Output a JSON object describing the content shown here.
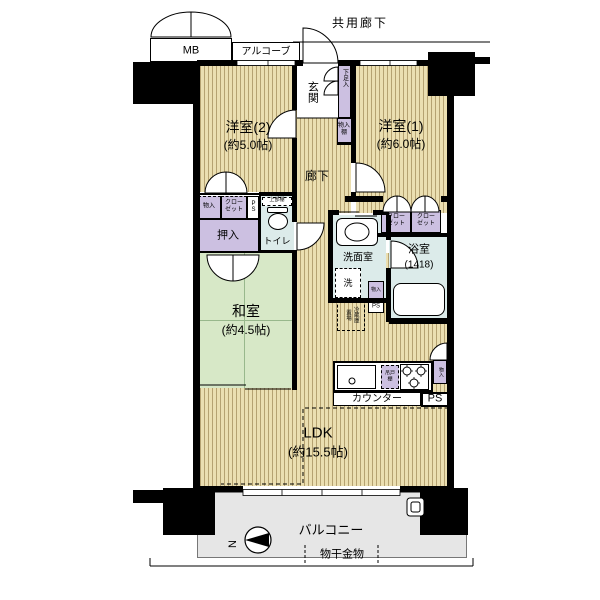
{
  "title": "マンション間取り図",
  "palette": {
    "wood": "#ebdfb1",
    "wood_stripe": "#b5a271",
    "tatami_green": "#d7e8c7",
    "storage_purple": "#ccc0e1",
    "wet_blue": "#dcebea",
    "balcony_gray": "#e6e6e6",
    "wall_black": "#000000"
  },
  "labels": {
    "shared_corridor": "共用廊下",
    "mb": "MB",
    "alcove": "アルコーブ",
    "entrance": "玄関",
    "shoe_cabinet": "下足入",
    "entrance_storage": "物入\n棚",
    "bedroom2_name": "洋室(2)",
    "bedroom2_size": "(約5.0帖)",
    "bedroom1_name": "洋室(1)",
    "bedroom1_size": "(約6.0帖)",
    "hallway": "廊下",
    "small_storage": "物入",
    "closet": "クロー\nゼット",
    "ps_shaft": "PS",
    "oshiire": "押入",
    "toilet": "トイレ",
    "toilet_shelf": "上部棚",
    "japanese_room_name": "和室",
    "japanese_room_size": "(約4.5帖)",
    "washroom": "洗面室",
    "washer": "洗",
    "washroom_storage": "物入",
    "bathroom": "浴室",
    "bathroom_size": "(1418)",
    "fridge_space": "冷蔵庫\n置場",
    "hanging_cabinet": "吊戸棚",
    "counter": "カウンター",
    "kitchen_ps": "PS",
    "kitchen_storage": "物入",
    "ldk_name": "LDK",
    "ldk_size": "(約15.5帖)",
    "balcony": "バルコニー",
    "laundry_hardware": "物干金物",
    "compass_n": "N"
  }
}
